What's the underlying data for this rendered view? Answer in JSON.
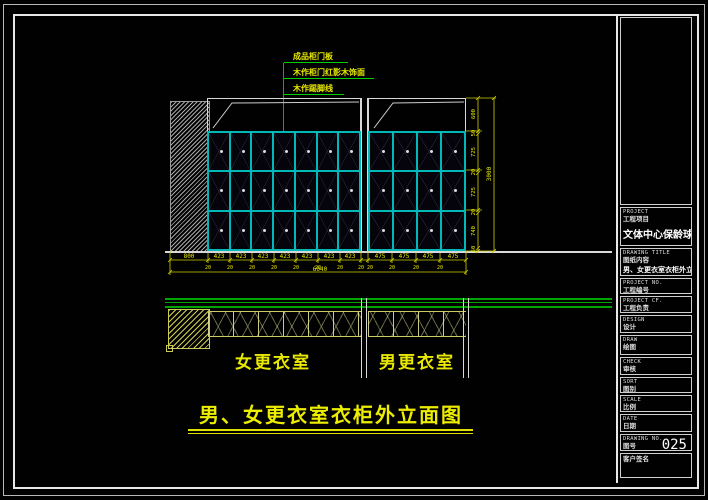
{
  "drawing": {
    "callouts": [
      "成品柜门板",
      "木作柜门红影木饰面",
      "木作踢脚线"
    ],
    "room_labels": {
      "left": "女更衣室",
      "right": "男更衣室"
    },
    "title": "男、女更衣室衣柜外立面图",
    "grid": {
      "rows": 3,
      "units": [
        {
          "cols": 7
        },
        {
          "cols": 4
        }
      ]
    },
    "dims": {
      "bottom": [
        "800",
        "423",
        "423",
        "423",
        "423",
        "423",
        "423",
        "423",
        "475",
        "475",
        "475",
        "475"
      ],
      "bottom_small": [
        "20",
        "20",
        "20",
        "20",
        "20",
        "20",
        "20",
        "20",
        "20",
        "20",
        "20",
        "20"
      ],
      "bottom_total": "6040",
      "right": [
        "600",
        "50",
        "725",
        "20",
        "725",
        "20",
        "740",
        "50"
      ],
      "right_total": "3000"
    }
  },
  "titleblock": {
    "rows": [
      {
        "en": "PROJECT",
        "cn": "工程项目",
        "value": "文体中心保龄球馆"
      },
      {
        "en": "DRAWING TITLE",
        "cn": "图纸内容",
        "value": "男、女更衣室衣柜外立面图"
      },
      {
        "en": "PROJECT NO.",
        "cn": "工程编号",
        "value": ""
      },
      {
        "en": "PROJECT CF.",
        "cn": "工程负责",
        "value": ""
      },
      {
        "en": "DESIGN",
        "cn": "设计",
        "value": ""
      },
      {
        "en": "DRAW",
        "cn": "绘图",
        "value": ""
      },
      {
        "en": "CHECK",
        "cn": "审核",
        "value": ""
      },
      {
        "en": "SORT",
        "cn": "图别",
        "value": ""
      },
      {
        "en": "SCALE",
        "cn": "比例",
        "value": ""
      },
      {
        "en": "DATE",
        "cn": "日期",
        "value": ""
      },
      {
        "en": "DRAWING NO.",
        "cn": "图号",
        "value": "025"
      },
      {
        "en": "",
        "cn": "客户签名",
        "value": ""
      }
    ]
  },
  "colors": {
    "background": "#000000",
    "grid_cyan": "#00b8b8",
    "annotation_green": "#00b400",
    "dim_yellow": "#e8e800",
    "title_yellow": "#eded00",
    "frame_white": "#e8e8e8"
  }
}
